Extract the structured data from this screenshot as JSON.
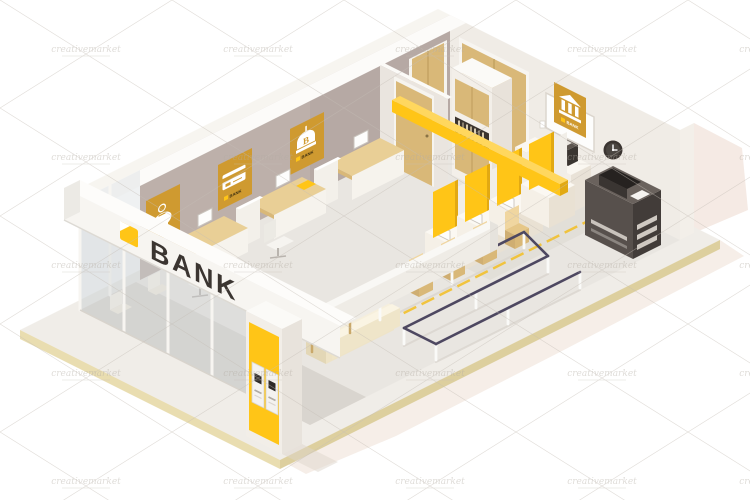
{
  "artwork": {
    "description": "Isometric low poly bank office interior cutaway illustration",
    "watermark": "creativemarket"
  },
  "storefront": {
    "sign_label": "BANK"
  },
  "posters": {
    "left_wall": [
      {
        "icon": "piggy-bank-icon",
        "caption": "BANK"
      },
      {
        "icon": "credit-card-icon",
        "caption": "BANK"
      },
      {
        "icon": "bank-emblem-icon",
        "caption": "BANK",
        "emblem_letter": "B"
      }
    ],
    "right_wall": [
      {
        "icon": "bank-building-icon",
        "caption": "BANK"
      }
    ]
  },
  "colors": {
    "accent": "#ffc517",
    "accent_light": "#ffd75e",
    "accent_dark": "#e2a912",
    "poster": "#cf9a30",
    "taupe": "#b6a9a4",
    "navy": "#4e4861",
    "wood": "#e9cf96",
    "door": "#d9b878",
    "dark": "#3b3531",
    "cream": "#f4ecd8",
    "glass": "#ccd2d6",
    "slab": "#f0ede8",
    "slab_edge": "#e9ddb0",
    "floor": "#e9e6e1",
    "floor_shadow": "#d6d1cb",
    "ext_shadow": "#ecd9cd",
    "wall_white": "#f0ece6",
    "wall_top": "#fcfbf9"
  }
}
